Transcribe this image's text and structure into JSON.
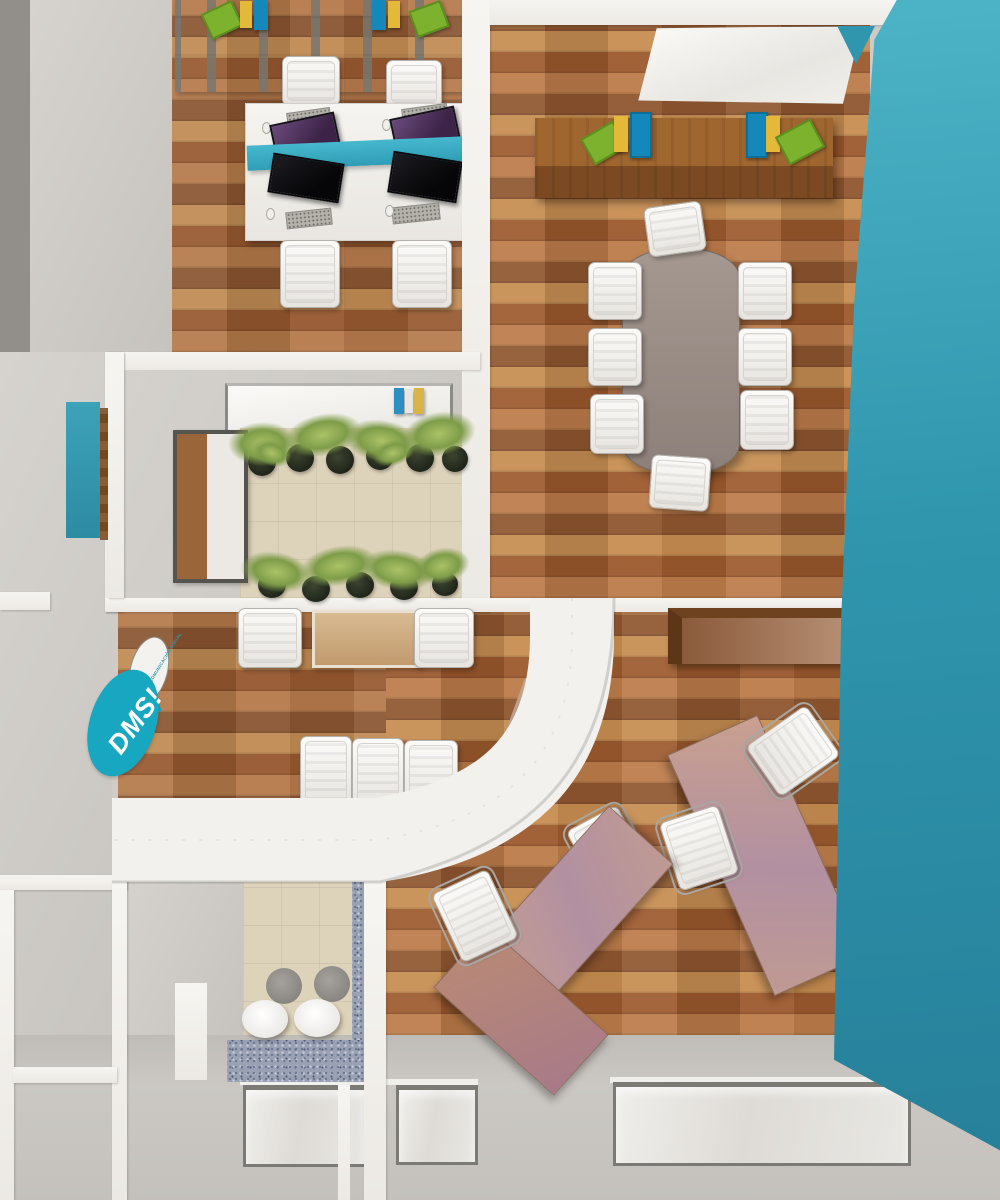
{
  "scene": {
    "title": "top-down 3d render of an office floor plan",
    "logo": {
      "text": "DMS!",
      "tagline": "DISEÑO Y COMUNICACIÓN VISUAL"
    },
    "palette": {
      "teal_accent_wall": "#2f96ae",
      "logo_teal": "#18a7c0",
      "wood_floor": "#a96e3f",
      "pink_desk_wood": "#c79e8e",
      "dark_credenza_wood": "#8a5228",
      "wall_cap_white": "#f3f1ed",
      "wall_gray": "#cfccc8",
      "granite_counter": "#99a1b3",
      "beige_tile": "#ddd2ba",
      "conference_table_gray": "#9e918a",
      "desk_divider_teal": "#3bb0c8",
      "binder_blue": "#1488ba",
      "binder_yellow": "#e4b93a",
      "binder_green": "#7cb22e"
    },
    "rooms": [
      {
        "name": "open-office",
        "items": [
          "filing-cabinet-row",
          "bench-desk",
          "teal-divider",
          "monitor x4",
          "keyboard x4",
          "white-chair x4",
          "binder-set x2"
        ]
      },
      {
        "name": "meeting-room",
        "items": [
          "whiteboard",
          "wood-credenza",
          "binder-set x2",
          "conference-table",
          "white-chair x8"
        ]
      },
      {
        "name": "indoor-garden",
        "items": [
          "skylight",
          "book-shelf",
          "wall-window",
          "planter x11"
        ]
      },
      {
        "name": "waiting-area",
        "items": [
          "guest-chair x2",
          "coffee-table",
          "guest-chair-row x3",
          "dms-logo-wall",
          "curved-wall"
        ]
      },
      {
        "name": "private-office",
        "items": [
          "wood-credenza",
          "angled-desk x2",
          "task-chair x2",
          "guest-chair x2",
          "reception-return"
        ]
      },
      {
        "name": "kitchenette",
        "items": [
          "granite-counter",
          "stool x2",
          "wall-niche"
        ]
      },
      {
        "name": "facade",
        "items": [
          "window x3",
          "teal-accent-wall"
        ]
      }
    ]
  }
}
